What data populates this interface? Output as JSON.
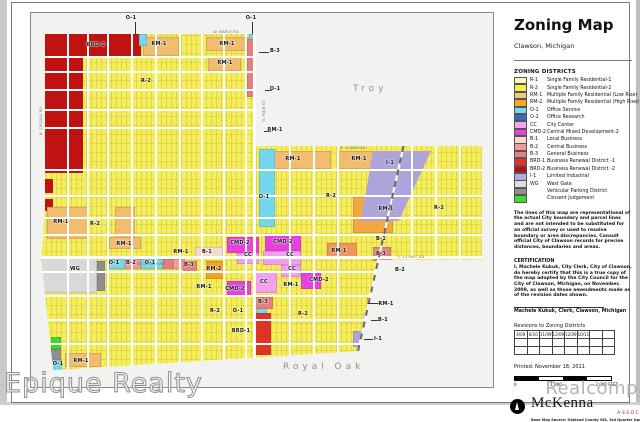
{
  "watermarks": {
    "left": "Epique Realty",
    "right": "Realcomp"
  },
  "panel": {
    "title": "Zoning Map",
    "subtitle": "Clawson, Michigan",
    "legend_heading": "ZONING DISTRICTS",
    "legend": [
      {
        "code": "R-1",
        "label": "Single Family Residential-1",
        "color": "#fdf7c0"
      },
      {
        "code": "R-2",
        "label": "Single Family Residential-2",
        "color": "#f8ee45"
      },
      {
        "code": "RM-1",
        "label": "Multiple Family Residential (Low Rise)",
        "color": "#f3c77d"
      },
      {
        "code": "RM-2",
        "label": "Multiple Family Residential (High Rise)",
        "color": "#f5a623"
      },
      {
        "code": "O-1",
        "label": "Office Service",
        "color": "#7fd9ee"
      },
      {
        "code": "O-2",
        "label": "Office Research",
        "color": "#3a66c8"
      },
      {
        "code": "CC",
        "label": "City Center",
        "color": "#f2a8e8"
      },
      {
        "code": "CMD-2",
        "label": "Central Mixed Development-2",
        "color": "#e83fe0"
      },
      {
        "code": "B-1",
        "label": "Local Business",
        "color": "#f5d9cb"
      },
      {
        "code": "B-2",
        "label": "Central Business",
        "color": "#f19c9c"
      },
      {
        "code": "B-3",
        "label": "General Business",
        "color": "#e87f7f"
      },
      {
        "code": "BRD-1",
        "label": "Business Renewal District -1",
        "color": "#de3426"
      },
      {
        "code": "BRD-2",
        "label": "Business Renewal District -2",
        "color": "#b80e0e"
      },
      {
        "code": "I-1",
        "label": "Limited Industrial",
        "color": "#b3aadf"
      },
      {
        "code": "WG",
        "label": "West Gate",
        "color": "#dcdcdc"
      },
      {
        "code": "",
        "label": "Vehicular Parking District",
        "color": "#8f8f8f"
      },
      {
        "code": "",
        "label": "Consent Judgement",
        "color": "#3adc2d"
      }
    ],
    "disclaimer": "The lines of this map are representational of the actual City boundary and parcel lines and are not intended to be substituted for an official survey or used to resolve boundary or area discrepancies. Consult official City of Clawson records for precise distances, boundaries and areas.",
    "certification_heading": "CERTIFICATION",
    "certification": "I, Machele Kukuk, City Clerk, City of Clawson, do hereby certify that this is a true copy of the map adopted by the City Council for the City of Clawson, Michigan, on November, 2009, as well as those amendments made as of the revision dates shown.",
    "signature": "Machele Kukuk, Clerk, Clawson, Michigan",
    "revisions_heading": "Revisions to Zoning Districts",
    "revision_dates": [
      "4/09",
      "6/10",
      "11/09",
      "12/09",
      "12/09",
      "10/11",
      "",
      ""
    ],
    "printed": "Printed: November 18, 2011",
    "scale": {
      "start": "0",
      "mid": "1,000",
      "end": "2,000 FEET"
    },
    "firm": {
      "name": "McKenna",
      "subname": "ASSOCIATES",
      "source": "Base Map Source: Oakland County GIS, 3rd Quarter Update, 2006"
    }
  },
  "map": {
    "neighbors": {
      "north": "Troy",
      "south": "Royal Oak"
    },
    "labels": [
      {
        "t": "BRD-2",
        "x": 65,
        "y": 32
      },
      {
        "t": "O-1",
        "x": 100,
        "y": 5
      },
      {
        "t": "O-1",
        "x": 220,
        "y": 5
      },
      {
        "t": "RM-1",
        "x": 128,
        "y": 31
      },
      {
        "t": "RM-1",
        "x": 196,
        "y": 31
      },
      {
        "t": "RM-1",
        "x": 194,
        "y": 50
      },
      {
        "t": "B-3",
        "x": 244,
        "y": 38
      },
      {
        "t": "O-1",
        "x": 244,
        "y": 76
      },
      {
        "t": "R-2",
        "x": 115,
        "y": 68
      },
      {
        "t": "RM-1",
        "x": 244,
        "y": 117
      },
      {
        "t": "R-2",
        "x": 300,
        "y": 183
      },
      {
        "t": "R-2",
        "x": 408,
        "y": 195
      },
      {
        "t": "I-1",
        "x": 359,
        "y": 150
      },
      {
        "t": "RM-1",
        "x": 355,
        "y": 196
      },
      {
        "t": "RM-1",
        "x": 262,
        "y": 146
      },
      {
        "t": "RM-1",
        "x": 328,
        "y": 146
      },
      {
        "t": "O-1",
        "x": 233,
        "y": 184
      },
      {
        "t": "RM-1",
        "x": 30,
        "y": 209
      },
      {
        "t": "R-2",
        "x": 64,
        "y": 211
      },
      {
        "t": "RM-1",
        "x": 93,
        "y": 231
      },
      {
        "t": "RM-1",
        "x": 150,
        "y": 239
      },
      {
        "t": "WG",
        "x": 44,
        "y": 256
      },
      {
        "t": "O-1",
        "x": 83,
        "y": 250
      },
      {
        "t": "B-2",
        "x": 100,
        "y": 250
      },
      {
        "t": "O-1",
        "x": 119,
        "y": 250
      },
      {
        "t": "B-1",
        "x": 176,
        "y": 239
      },
      {
        "t": "B-3",
        "x": 158,
        "y": 252
      },
      {
        "t": "RM-2",
        "x": 183,
        "y": 256
      },
      {
        "t": "RM-1",
        "x": 173,
        "y": 274
      },
      {
        "t": "CMD-2",
        "x": 209,
        "y": 230
      },
      {
        "t": "CMD-2",
        "x": 252,
        "y": 229
      },
      {
        "t": "CC",
        "x": 217,
        "y": 242
      },
      {
        "t": "CC",
        "x": 259,
        "y": 242
      },
      {
        "t": "RM-1",
        "x": 308,
        "y": 238
      },
      {
        "t": "CC",
        "x": 261,
        "y": 256
      },
      {
        "t": "CC",
        "x": 233,
        "y": 269
      },
      {
        "t": "CMD-2",
        "x": 204,
        "y": 276
      },
      {
        "t": "RM-1",
        "x": 260,
        "y": 272
      },
      {
        "t": "CMD-2",
        "x": 288,
        "y": 267
      },
      {
        "t": "R-2",
        "x": 184,
        "y": 298
      },
      {
        "t": "O-1",
        "x": 207,
        "y": 298
      },
      {
        "t": "B-3",
        "x": 232,
        "y": 289
      },
      {
        "t": "BRD-1",
        "x": 210,
        "y": 318
      },
      {
        "t": "R-2",
        "x": 272,
        "y": 301
      },
      {
        "t": "B-1",
        "x": 350,
        "y": 226
      },
      {
        "t": "B-3",
        "x": 350,
        "y": 241
      },
      {
        "t": "B-2",
        "x": 369,
        "y": 257
      },
      {
        "t": "RM-1",
        "x": 355,
        "y": 291
      },
      {
        "t": "B-1",
        "x": 352,
        "y": 307
      },
      {
        "t": "I-1",
        "x": 347,
        "y": 326
      },
      {
        "t": "O-1",
        "x": 27,
        "y": 351
      },
      {
        "t": "RM-1",
        "x": 50,
        "y": 348
      }
    ],
    "road_labels": [
      {
        "t": "W. MAPLE RD",
        "x": 195,
        "y": 19
      },
      {
        "t": "E. ELMWOOD",
        "x": 322,
        "y": 135
      },
      {
        "t": "W. 14 MILE RD",
        "x": 120,
        "y": 251
      },
      {
        "t": "E. 14 MILE RD",
        "x": 380,
        "y": 244
      },
      {
        "t": "N. MAIN ST",
        "x": 233,
        "y": 98,
        "v": true
      },
      {
        "t": "N. CROOKS RD",
        "x": 10,
        "y": 108,
        "v": true
      }
    ]
  }
}
